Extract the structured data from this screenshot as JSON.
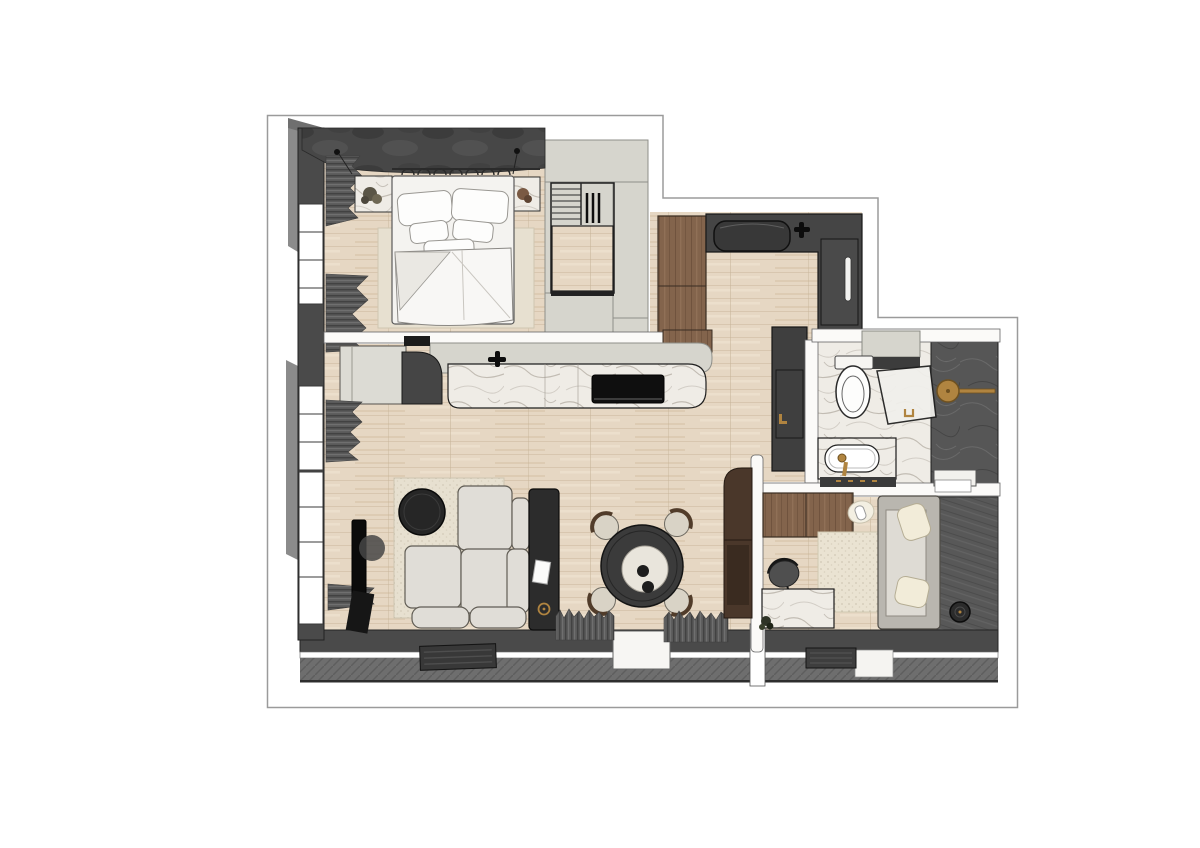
{
  "meta": {
    "description": "3D rendered top-down floor plan of a one-bedroom apartment with loft stair"
  },
  "colors": {
    "background": "#ffffff",
    "outline_stroke": "#9b9b9b",
    "wall_dark": "#4a4a4a",
    "wall_black_line": "#1b1b1b",
    "terrace_gray": "#6e6e6e",
    "wood_floor": "#e6d7c3",
    "sage_cabinet": "#d6d5cd",
    "walnut_cabinet": "#83644c",
    "walnut_dark": "#4a372a",
    "marble_light": "#efece6",
    "dark_marble": "#565656",
    "upholstery_light": "#dfdcd6",
    "textile_white": "#f6f5f3",
    "rug_beige": "#e7e0d0",
    "accent_black": "#232323",
    "brass_gold": "#b08440",
    "drape_gray": "#5a5a5a",
    "glass_white": "#f1f0ec"
  },
  "scene": {
    "rooms": [
      {
        "name": "bedroom",
        "items": [
          "double-bed",
          "pillows",
          "duvet",
          "area-rug",
          "nightstand-left",
          "nightstand-right",
          "wardrobe-wall",
          "pendant-lights",
          "window-curtains"
        ]
      },
      {
        "name": "staircase",
        "items": [
          "stair-treads",
          "railing-balusters",
          "wood-landing",
          "storage-surround"
        ]
      },
      {
        "name": "kitchen",
        "items": [
          "wood-cabinet-column",
          "dark-counter",
          "sink",
          "faucet",
          "tall-fridge-unit",
          "hall-wardrobe"
        ]
      },
      {
        "name": "island-counter",
        "items": [
          "sage-counter-band",
          "marble-counter",
          "induction-cooktop",
          "island-faucet",
          "side-cabinet"
        ]
      },
      {
        "name": "living-room",
        "items": [
          "modular-sofa",
          "sofa-console",
          "coffee-table",
          "area-rug",
          "tv",
          "dining-table",
          "dining-chairs",
          "window-curtains"
        ]
      },
      {
        "name": "bathroom",
        "items": [
          "toilet",
          "glass-shower-door",
          "rain-shower-head",
          "marble-vanity",
          "sink",
          "shelf"
        ]
      },
      {
        "name": "study-room",
        "items": [
          "wardrobe",
          "marble-desk",
          "office-chair",
          "area-rug",
          "sofa-daybed",
          "robot-vacuum",
          "plant"
        ]
      },
      {
        "name": "balcony",
        "items": [
          "doormats",
          "sliding-door-openings",
          "deck-floor"
        ]
      }
    ]
  }
}
